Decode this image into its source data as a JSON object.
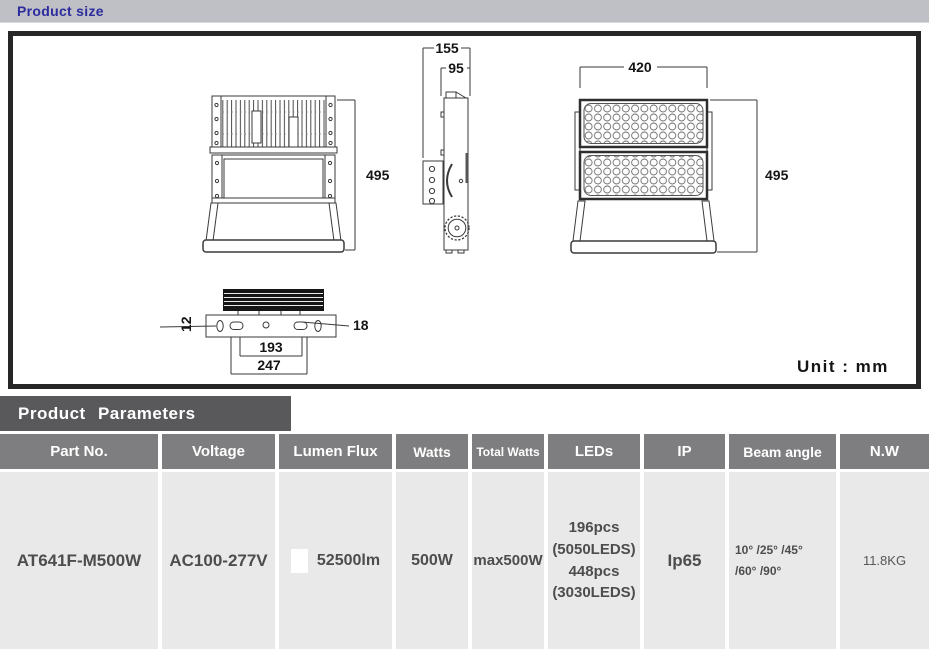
{
  "product_size": {
    "title": "Product size",
    "unit_label": "Unit : mm",
    "dims": {
      "side_overall_width": "155",
      "side_body_width": "95",
      "front_width": "420",
      "back_height": "495",
      "front_height": "495",
      "mount_slot_width": "12",
      "mount_hole": "18",
      "mount_span_inner": "193",
      "mount_span_outer": "247"
    }
  },
  "product_parameters": {
    "title": "Product Parameters",
    "columns": [
      "Part No.",
      "Voltage",
      "Lumen Flux",
      "Watts",
      "Total Watts",
      "LEDs",
      "IP",
      "Beam angle",
      "N.W"
    ],
    "row": {
      "part_no": "AT641F-M500W",
      "voltage": "AC100-277V",
      "lumen_flux": "52500lm",
      "watts": "500W",
      "total_watts": "max500W",
      "leds": [
        "196pcs",
        "(5050LEDS)",
        "448pcs",
        "(3030LEDS)"
      ],
      "ip": "Ip65",
      "beam_angle": [
        "10° /25° /45°",
        "/60° /90°"
      ],
      "nw": "11.8KG"
    }
  },
  "colors": {
    "accent_blue": "#2b2b9e",
    "title_bar_gray": "#bfc0c5",
    "panel_dark": "#59595b",
    "table_header_gray": "#7e7e80",
    "table_body_gray": "#e9e9ea",
    "swatch_white": "#ffffff"
  }
}
